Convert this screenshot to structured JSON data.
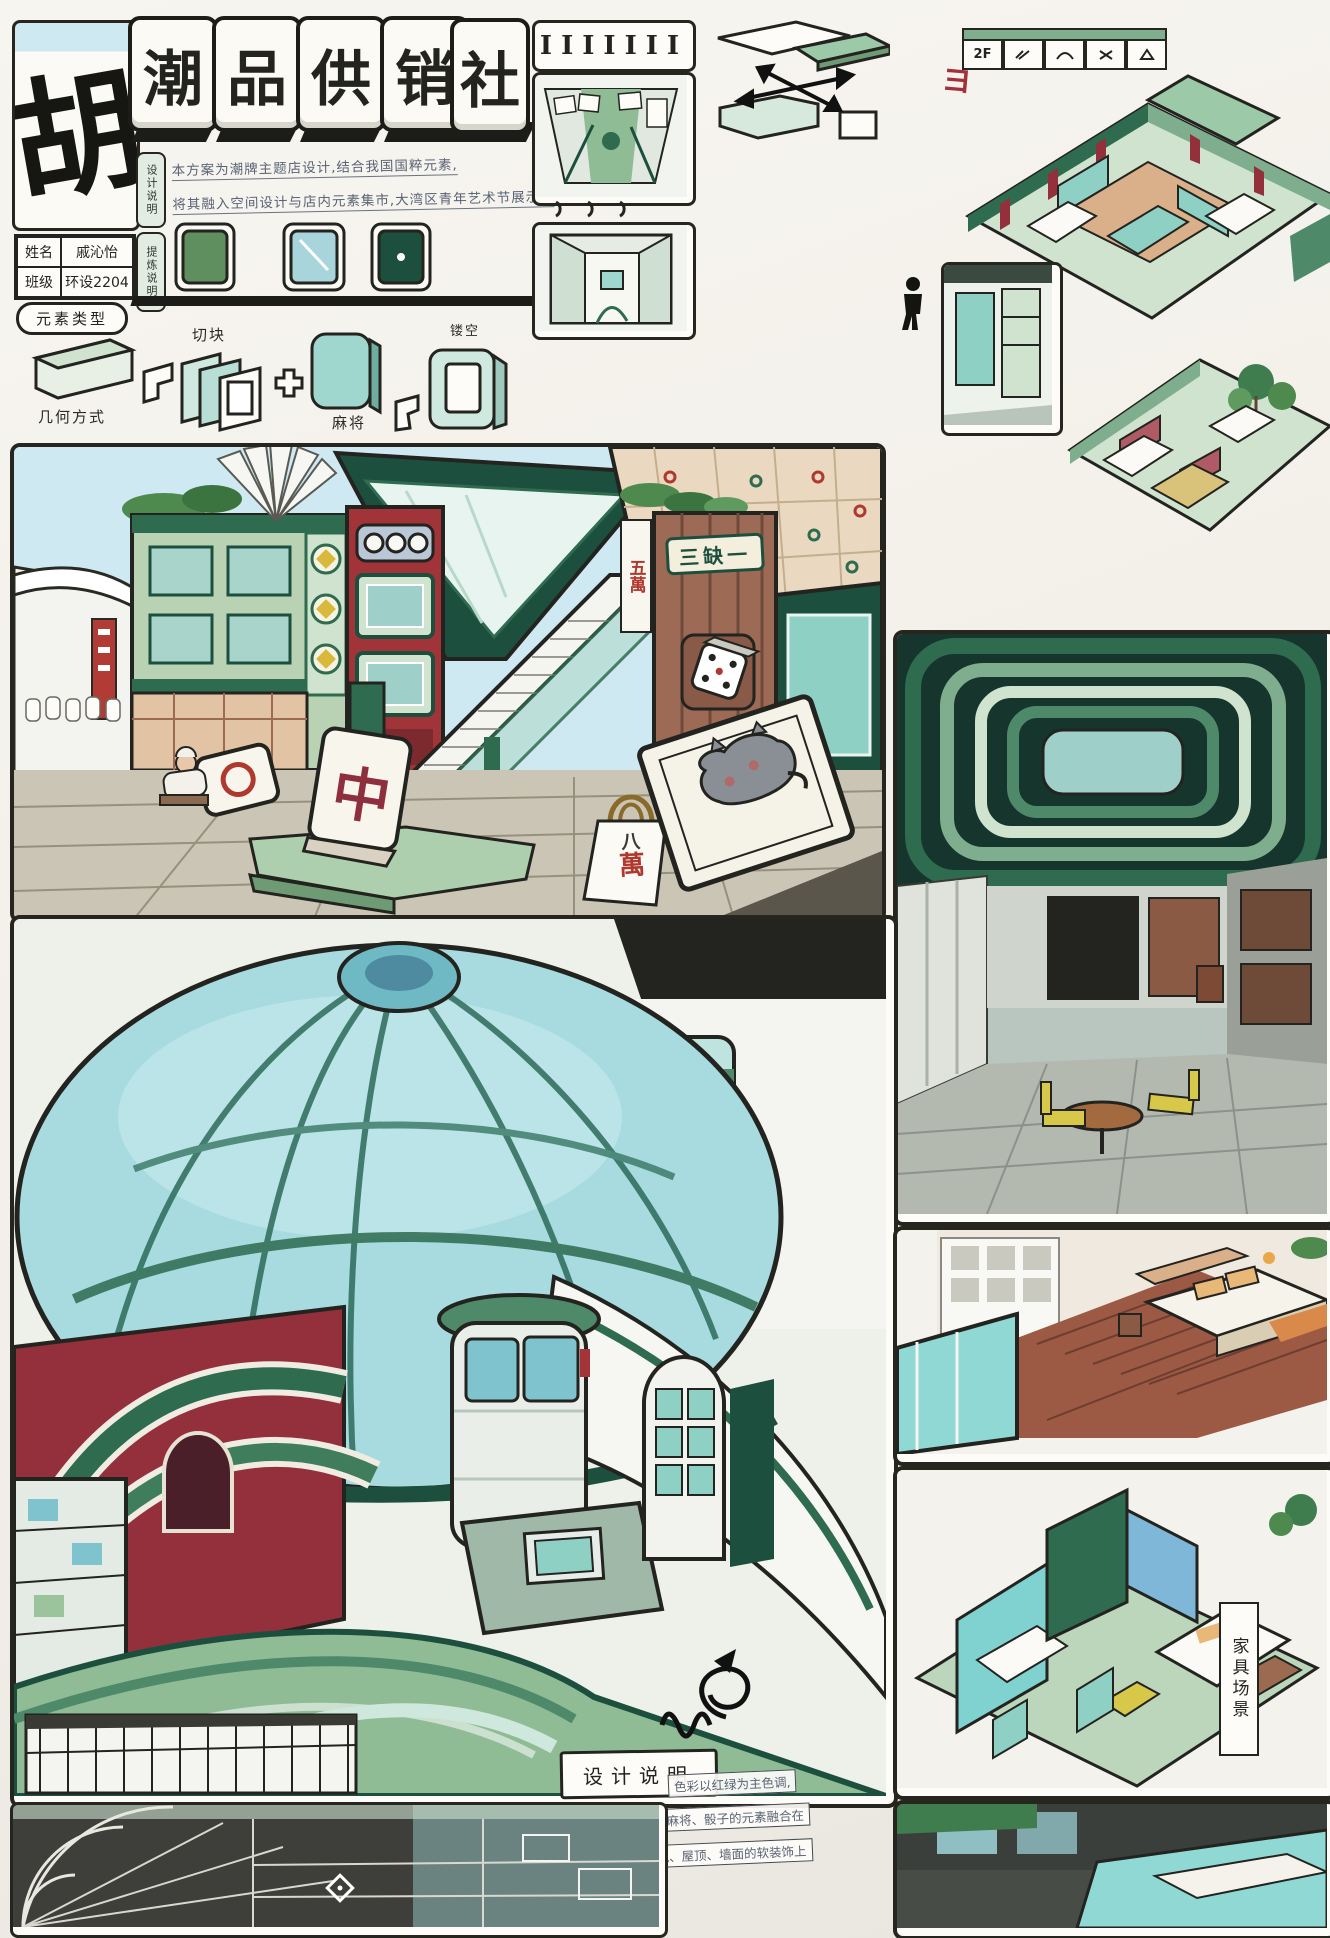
{
  "palette": {
    "ink": "#23231f",
    "deep_green": "#1d4f3e",
    "mid_green": "#7fae8e",
    "light_green": "#bcd6bc",
    "teal": "#8fd0cd",
    "sky": "#cfe9f2",
    "maroon": "#973341",
    "red": "#b0392f",
    "wood": "#9c6a50",
    "tan": "#e8cdae",
    "yellow": "#d8b93c",
    "paper": "#f7f5f0"
  },
  "header": {
    "logo_char": "胡",
    "title_tiles": [
      "潮",
      "品",
      "供",
      "销",
      "社"
    ],
    "tab_design_note": "设计说明",
    "tab_refine_note": "提炼说明",
    "intro_line1": "本方案为潮牌主题店设计,结合我国国粹元素,",
    "intro_line2": "将其融入空间设计与店内元素集市,大湾区青年艺术节展示。",
    "name_label": "姓名",
    "name_value": "戚沁怡",
    "class_label": "班级",
    "class_value": "环设2204",
    "element_type_label": "元素类型"
  },
  "process": {
    "geometry_label": "几何方式",
    "cut_label": "切块",
    "plus_sign": "+",
    "mahjong_label": "麻将",
    "hollow_label": "镂空"
  },
  "top_panels": {
    "tile_marks": "IIIIIII"
  },
  "floorplan": {
    "legend_floor": "2F",
    "red_mark": "ヨ"
  },
  "scene": {
    "sign_sanquyi": "三缺一",
    "sign_wuwan": "五萬",
    "tile_zhong": "中",
    "bag_line1": "八",
    "bag_line2": "萬"
  },
  "bottom": {
    "design_desc_label": "设计说明",
    "note_line1": "色彩以红绿为主色调,",
    "note_line2": "把麻将、骰子的元素融合在",
    "note_line3": "屏风、屋顶、墙面的软装饰上",
    "furniture_label": "家具场景"
  }
}
